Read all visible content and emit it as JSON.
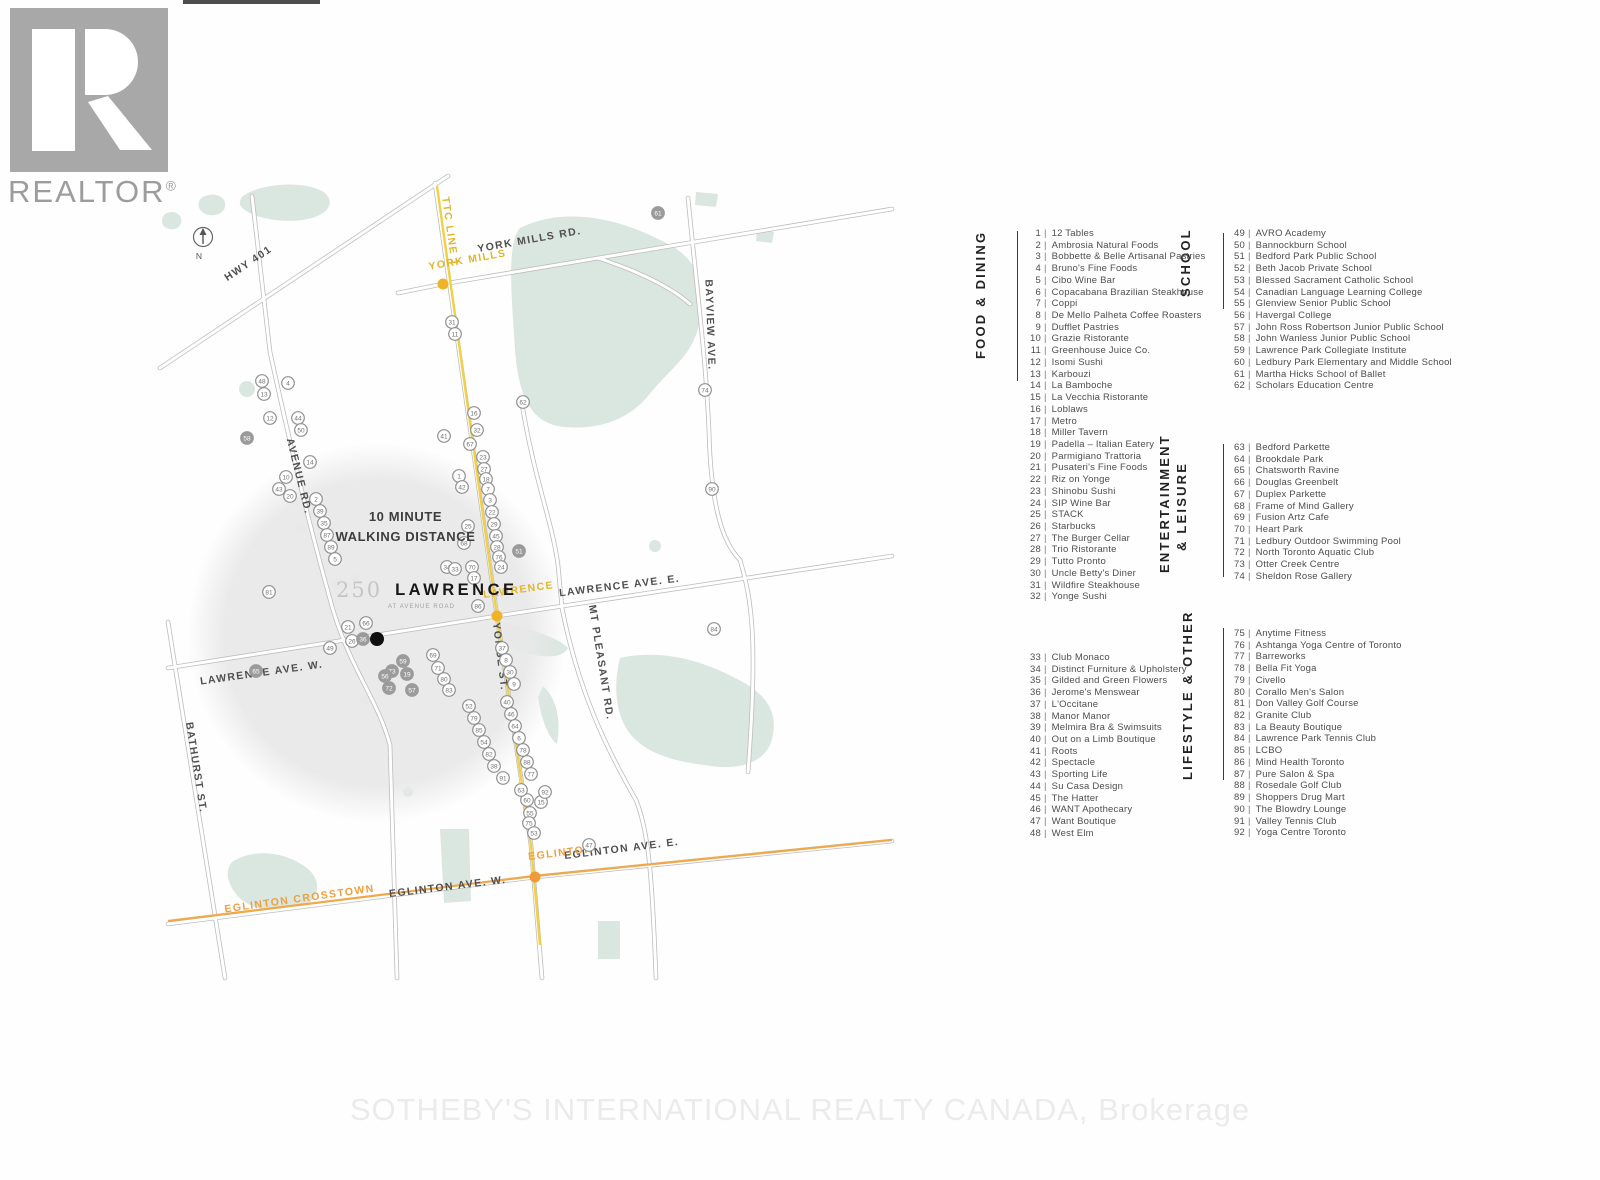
{
  "branding": {
    "realtor_text": "REALTOR",
    "registered": "®"
  },
  "watermark": "SOTHEBY'S INTERNATIONAL REALTY CANADA, Brokerage",
  "legend": {
    "separator": "|",
    "food": {
      "title": "FOOD & DINING",
      "items": [
        {
          "n": 1,
          "name": "12 Tables"
        },
        {
          "n": 2,
          "name": "Ambrosia Natural Foods"
        },
        {
          "n": 3,
          "name": "Bobbette & Belle Artisanal Pastries"
        },
        {
          "n": 4,
          "name": "Bruno's Fine Foods"
        },
        {
          "n": 5,
          "name": "Cibo Wine Bar"
        },
        {
          "n": 6,
          "name": "Copacabana Brazilian Steakhouse"
        },
        {
          "n": 7,
          "name": "Coppi"
        },
        {
          "n": 8,
          "name": "De Mello Palheta Coffee Roasters"
        },
        {
          "n": 9,
          "name": "Dufflet Pastries"
        },
        {
          "n": 10,
          "name": "Grazie Ristorante"
        },
        {
          "n": 11,
          "name": "Greenhouse Juice Co."
        },
        {
          "n": 12,
          "name": "Isomi Sushi"
        },
        {
          "n": 13,
          "name": "Karbouzi"
        },
        {
          "n": 14,
          "name": "La Bamboche"
        },
        {
          "n": 15,
          "name": "La Vecchia Ristorante"
        },
        {
          "n": 16,
          "name": "Loblaws"
        },
        {
          "n": 17,
          "name": "Metro"
        },
        {
          "n": 18,
          "name": "Miller Tavern"
        },
        {
          "n": 19,
          "name": "Padella – Italian Eatery"
        },
        {
          "n": 20,
          "name": "Parmigiano Trattoria"
        },
        {
          "n": 21,
          "name": "Pusateri's Fine Foods"
        },
        {
          "n": 22,
          "name": "Riz on Yonge"
        },
        {
          "n": 23,
          "name": "Shinobu Sushi"
        },
        {
          "n": 24,
          "name": "SIP Wine Bar"
        },
        {
          "n": 25,
          "name": "STACK"
        },
        {
          "n": 26,
          "name": "Starbucks"
        },
        {
          "n": 27,
          "name": "The Burger Cellar"
        },
        {
          "n": 28,
          "name": "Trio Ristorante"
        },
        {
          "n": 29,
          "name": "Tutto Pronto"
        },
        {
          "n": 30,
          "name": "Uncle Betty's Diner"
        },
        {
          "n": 31,
          "name": "Wildfire Steakhouse"
        },
        {
          "n": 32,
          "name": "Yonge Sushi"
        }
      ]
    },
    "school": {
      "title": "SCHOOL",
      "items": [
        {
          "n": 49,
          "name": "AVRO Academy"
        },
        {
          "n": 50,
          "name": "Bannockburn School"
        },
        {
          "n": 51,
          "name": "Bedford Park Public School"
        },
        {
          "n": 52,
          "name": "Beth Jacob Private School"
        },
        {
          "n": 53,
          "name": "Blessed Sacrament Catholic School"
        },
        {
          "n": 54,
          "name": "Canadian Language Learning College"
        },
        {
          "n": 55,
          "name": "Glenview Senior Public School"
        },
        {
          "n": 56,
          "name": "Havergal College"
        },
        {
          "n": 57,
          "name": "John Ross Robertson Junior Public School"
        },
        {
          "n": 58,
          "name": "John Wanless Junior Public School"
        },
        {
          "n": 59,
          "name": "Lawrence Park Collegiate Institute"
        },
        {
          "n": 60,
          "name": "Ledbury Park Elementary and Middle School"
        },
        {
          "n": 61,
          "name": "Martha Hicks School of Ballet"
        },
        {
          "n": 62,
          "name": "Scholars Education Centre"
        }
      ]
    },
    "entertainment": {
      "title_line1": "ENTERTAINMENT",
      "title_line2": "& LEISURE",
      "items": [
        {
          "n": 63,
          "name": "Bedford Parkette"
        },
        {
          "n": 64,
          "name": "Brookdale Park"
        },
        {
          "n": 65,
          "name": "Chatsworth Ravine"
        },
        {
          "n": 66,
          "name": "Douglas Greenbelt"
        },
        {
          "n": 67,
          "name": "Duplex Parkette"
        },
        {
          "n": 68,
          "name": "Frame of Mind Gallery"
        },
        {
          "n": 69,
          "name": "Fusion Artz Cafe"
        },
        {
          "n": 70,
          "name": "Heart Park"
        },
        {
          "n": 71,
          "name": "Ledbury Outdoor Swimming Pool"
        },
        {
          "n": 72,
          "name": "North Toronto Aquatic Club"
        },
        {
          "n": 73,
          "name": "Otter Creek Centre"
        },
        {
          "n": 74,
          "name": "Sheldon Rose Gallery"
        }
      ]
    },
    "lifestyle": {
      "title": "LIFESTYLE & OTHER",
      "items_a": [
        {
          "n": 33,
          "name": "Club Monaco"
        },
        {
          "n": 34,
          "name": "Distinct Furniture & Upholstery"
        },
        {
          "n": 35,
          "name": "Gilded and Green Flowers"
        },
        {
          "n": 36,
          "name": "Jerome's Menswear"
        },
        {
          "n": 37,
          "name": "L'Occitane"
        },
        {
          "n": 38,
          "name": "Manor Manor"
        },
        {
          "n": 39,
          "name": "Melmira Bra & Swimsuits"
        },
        {
          "n": 40,
          "name": "Out on a Limb Boutique"
        },
        {
          "n": 41,
          "name": "Roots"
        },
        {
          "n": 42,
          "name": "Spectacle"
        },
        {
          "n": 43,
          "name": "Sporting Life"
        },
        {
          "n": 44,
          "name": "Su Casa Design"
        },
        {
          "n": 45,
          "name": "The Hatter"
        },
        {
          "n": 46,
          "name": "WANT Apothecary"
        },
        {
          "n": 47,
          "name": "Want Boutique"
        },
        {
          "n": 48,
          "name": "West Elm"
        }
      ],
      "items_b": [
        {
          "n": 75,
          "name": "Anytime Fitness"
        },
        {
          "n": 76,
          "name": "Ashtanga Yoga Centre of Toronto"
        },
        {
          "n": 77,
          "name": "Barreworks"
        },
        {
          "n": 78,
          "name": "Bella Fit Yoga"
        },
        {
          "n": 79,
          "name": "Civello"
        },
        {
          "n": 80,
          "name": "Corallo Men's Salon"
        },
        {
          "n": 81,
          "name": "Don Valley Golf Course"
        },
        {
          "n": 82,
          "name": "Granite Club"
        },
        {
          "n": 83,
          "name": "La Beauty Boutique"
        },
        {
          "n": 84,
          "name": "Lawrence Park Tennis Club"
        },
        {
          "n": 85,
          "name": "LCBO"
        },
        {
          "n": 86,
          "name": "Mind Health Toronto"
        },
        {
          "n": 87,
          "name": "Pure Salon & Spa"
        },
        {
          "n": 88,
          "name": "Rosedale Golf Club"
        },
        {
          "n": 89,
          "name": "Shoppers Drug Mart"
        },
        {
          "n": 90,
          "name": "The Blowdry Lounge"
        },
        {
          "n": 91,
          "name": "Valley Tennis Club"
        },
        {
          "n": 92,
          "name": "Yoga Centre Toronto"
        }
      ]
    }
  },
  "map": {
    "title_number": "250",
    "title_name": "LAWRENCE",
    "title_tagline": "AT AVENUE ROAD",
    "walking_line1": "10 MINUTE",
    "walking_line2": "WALKING DISTANCE",
    "compass_n": "N",
    "colors": {
      "subway_yellow": "#f2d044",
      "crosstown_orange": "#f0a848",
      "station_gold": "#efb32a",
      "station_orange": "#ef9b3a",
      "park_green": "#dae6e0",
      "walk_circle_gray": "#e8e8e8",
      "label_gold": "#e2b52a",
      "label_orange": "#ee9f3e"
    },
    "road_labels": [
      {
        "text": "YORK MILLS RD.",
        "x": 530,
        "y": 243,
        "rot": -10,
        "cls": ""
      },
      {
        "text": "BAYVIEW AVE.",
        "x": 707,
        "y": 325,
        "rot": 88,
        "cls": ""
      },
      {
        "text": "HWY 401",
        "x": 250,
        "y": 266,
        "rot": -34,
        "cls": ""
      },
      {
        "text": "AVENUE RD.",
        "x": 296,
        "y": 477,
        "rot": 76,
        "cls": ""
      },
      {
        "text": "LAWRENCE AVE. E.",
        "x": 620,
        "y": 589,
        "rot": -7,
        "cls": ""
      },
      {
        "text": "LAWRENCE AVE. W.",
        "x": 262,
        "y": 676,
        "rot": -8,
        "cls": ""
      },
      {
        "text": "YONGE ST.",
        "x": 497,
        "y": 657,
        "rot": 83,
        "cls": ""
      },
      {
        "text": "MT PLEASANT RD.",
        "x": 598,
        "y": 663,
        "rot": 81,
        "cls": ""
      },
      {
        "text": "BATHURST ST.",
        "x": 193,
        "y": 768,
        "rot": 81,
        "cls": ""
      },
      {
        "text": "EGLINTON AVE. W.",
        "x": 448,
        "y": 890,
        "rot": -7,
        "cls": ""
      },
      {
        "text": "EGLINTON AVE. E.",
        "x": 622,
        "y": 852,
        "rot": -7,
        "cls": ""
      },
      {
        "text": "TTC LINE 1",
        "x": 447,
        "y": 232,
        "rot": 82,
        "cls": "gold"
      },
      {
        "text": "YORK MILLS",
        "x": 468,
        "y": 263,
        "rot": -10,
        "cls": "gold"
      },
      {
        "text": "LAWRENCE",
        "x": 519,
        "y": 593,
        "rot": -8,
        "cls": "gold"
      },
      {
        "text": "EGLINTON",
        "x": 561,
        "y": 856,
        "rot": -7,
        "cls": "orange"
      },
      {
        "text": "EGLINTON CROSSTOWN",
        "x": 300,
        "y": 902,
        "rot": -8,
        "cls": "orange"
      }
    ],
    "stations": [
      {
        "x": 443,
        "y": 284,
        "cls": "gold"
      },
      {
        "x": 497,
        "y": 616,
        "cls": "gold"
      },
      {
        "x": 535,
        "y": 877,
        "cls": "orange"
      }
    ],
    "site": {
      "x": 377,
      "y": 639
    },
    "markers": [
      {
        "n": 48,
        "x": 262,
        "y": 381
      },
      {
        "n": 13,
        "x": 264,
        "y": 394
      },
      {
        "n": 4,
        "x": 288,
        "y": 383
      },
      {
        "n": 12,
        "x": 270,
        "y": 418
      },
      {
        "n": 44,
        "x": 298,
        "y": 418
      },
      {
        "n": 50,
        "x": 301,
        "y": 430
      },
      {
        "n": 58,
        "x": 247,
        "y": 438,
        "f": 1
      },
      {
        "n": 14,
        "x": 310,
        "y": 462
      },
      {
        "n": 10,
        "x": 286,
        "y": 477
      },
      {
        "n": 43,
        "x": 279,
        "y": 489
      },
      {
        "n": 20,
        "x": 290,
        "y": 496
      },
      {
        "n": 2,
        "x": 316,
        "y": 499
      },
      {
        "n": 39,
        "x": 320,
        "y": 511
      },
      {
        "n": 35,
        "x": 324,
        "y": 523
      },
      {
        "n": 87,
        "x": 327,
        "y": 535
      },
      {
        "n": 89,
        "x": 331,
        "y": 547
      },
      {
        "n": 81,
        "x": 269,
        "y": 592
      },
      {
        "n": 5,
        "x": 335,
        "y": 559
      },
      {
        "n": 21,
        "x": 348,
        "y": 627
      },
      {
        "n": 66,
        "x": 366,
        "y": 623
      },
      {
        "n": 26,
        "x": 352,
        "y": 641
      },
      {
        "n": 36,
        "x": 363,
        "y": 639,
        "f": 1
      },
      {
        "n": 49,
        "x": 330,
        "y": 648
      },
      {
        "n": 65,
        "x": 256,
        "y": 671,
        "f": 1
      },
      {
        "n": 59,
        "x": 403,
        "y": 661,
        "f": 1
      },
      {
        "n": 73,
        "x": 392,
        "y": 671,
        "f": 1
      },
      {
        "n": 19,
        "x": 407,
        "y": 674,
        "f": 1
      },
      {
        "n": 56,
        "x": 385,
        "y": 676,
        "f": 1
      },
      {
        "n": 72,
        "x": 389,
        "y": 688,
        "f": 1
      },
      {
        "n": 57,
        "x": 412,
        "y": 690,
        "f": 1
      },
      {
        "n": 1,
        "x": 459,
        "y": 476
      },
      {
        "n": 42,
        "x": 462,
        "y": 487
      },
      {
        "n": 25,
        "x": 468,
        "y": 526
      },
      {
        "n": 68,
        "x": 464,
        "y": 543
      },
      {
        "n": 34,
        "x": 447,
        "y": 567
      },
      {
        "n": 33,
        "x": 455,
        "y": 569
      },
      {
        "n": 70,
        "x": 472,
        "y": 567
      },
      {
        "n": 17,
        "x": 474,
        "y": 578
      },
      {
        "n": 86,
        "x": 478,
        "y": 606
      },
      {
        "n": 31,
        "x": 452,
        "y": 322
      },
      {
        "n": 11,
        "x": 455,
        "y": 334
      },
      {
        "n": 41,
        "x": 444,
        "y": 436
      },
      {
        "n": 16,
        "x": 474,
        "y": 413
      },
      {
        "n": 32,
        "x": 477,
        "y": 430
      },
      {
        "n": 67,
        "x": 470,
        "y": 444
      },
      {
        "n": 23,
        "x": 483,
        "y": 457
      },
      {
        "n": 27,
        "x": 484,
        "y": 469
      },
      {
        "n": 18,
        "x": 486,
        "y": 479
      },
      {
        "n": 7,
        "x": 488,
        "y": 489
      },
      {
        "n": 3,
        "x": 490,
        "y": 500
      },
      {
        "n": 22,
        "x": 492,
        "y": 512
      },
      {
        "n": 29,
        "x": 494,
        "y": 524
      },
      {
        "n": 45,
        "x": 496,
        "y": 536
      },
      {
        "n": 28,
        "x": 497,
        "y": 547
      },
      {
        "n": 76,
        "x": 499,
        "y": 557
      },
      {
        "n": 24,
        "x": 501,
        "y": 567
      },
      {
        "n": 51,
        "x": 519,
        "y": 551,
        "f": 1
      },
      {
        "n": 62,
        "x": 523,
        "y": 402
      },
      {
        "n": 61,
        "x": 658,
        "y": 213,
        "f": 1
      },
      {
        "n": 90,
        "x": 712,
        "y": 489
      },
      {
        "n": 74,
        "x": 705,
        "y": 390
      },
      {
        "n": 84,
        "x": 714,
        "y": 629
      },
      {
        "n": 37,
        "x": 502,
        "y": 648
      },
      {
        "n": 8,
        "x": 506,
        "y": 660
      },
      {
        "n": 30,
        "x": 510,
        "y": 672
      },
      {
        "n": 9,
        "x": 514,
        "y": 684
      },
      {
        "n": 40,
        "x": 507,
        "y": 702
      },
      {
        "n": 46,
        "x": 511,
        "y": 714
      },
      {
        "n": 64,
        "x": 515,
        "y": 726
      },
      {
        "n": 6,
        "x": 519,
        "y": 738
      },
      {
        "n": 78,
        "x": 523,
        "y": 750
      },
      {
        "n": 88,
        "x": 527,
        "y": 762
      },
      {
        "n": 77,
        "x": 531,
        "y": 774
      },
      {
        "n": 52,
        "x": 469,
        "y": 706
      },
      {
        "n": 79,
        "x": 474,
        "y": 718
      },
      {
        "n": 85,
        "x": 479,
        "y": 730
      },
      {
        "n": 54,
        "x": 484,
        "y": 742
      },
      {
        "n": 82,
        "x": 489,
        "y": 754
      },
      {
        "n": 38,
        "x": 494,
        "y": 766
      },
      {
        "n": 69,
        "x": 433,
        "y": 655
      },
      {
        "n": 71,
        "x": 438,
        "y": 668
      },
      {
        "n": 80,
        "x": 444,
        "y": 679
      },
      {
        "n": 83,
        "x": 449,
        "y": 690
      },
      {
        "n": 60,
        "x": 527,
        "y": 800
      },
      {
        "n": 15,
        "x": 541,
        "y": 802
      },
      {
        "n": 55,
        "x": 530,
        "y": 813
      },
      {
        "n": 75,
        "x": 529,
        "y": 823
      },
      {
        "n": 47,
        "x": 589,
        "y": 845
      },
      {
        "n": 63,
        "x": 521,
        "y": 790
      },
      {
        "n": 53,
        "x": 534,
        "y": 833
      },
      {
        "n": 91,
        "x": 503,
        "y": 778
      },
      {
        "n": 92,
        "x": 545,
        "y": 792
      }
    ]
  }
}
